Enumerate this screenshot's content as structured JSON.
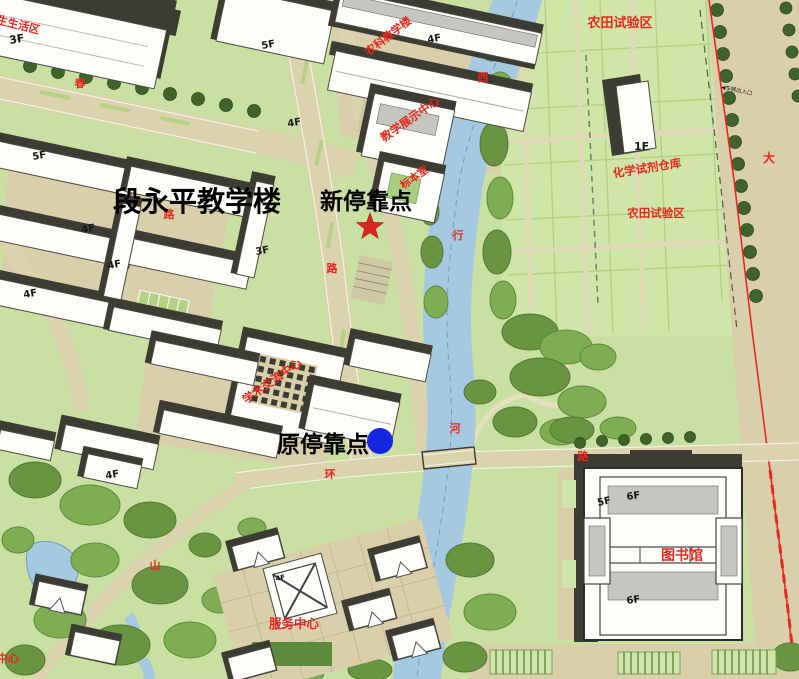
{
  "annotations": {
    "main_building": "段永平教学楼",
    "new_stop": "新停靠点",
    "old_stop": "原停靠点"
  },
  "markers": {
    "new_stop_type": "red-star",
    "old_stop_type": "blue-dot"
  },
  "map_labels": {
    "farmland_north": "农田试验区",
    "farmland_south": "农田试验区",
    "chemical_warehouse": "化学试剂仓库",
    "agri_teaching_building": "农科教学楼",
    "teaching_exhibition_center": "教学展示中心",
    "specimen_room": "标本室",
    "exchange_center": "学术交流中心",
    "library": "图书馆",
    "service_center": "服务中心",
    "student_area_partial": "学生生活区",
    "center_partial": "中心",
    "vehicle_entrance": "◀车辆出入口"
  },
  "floor_labels": [
    "3F",
    "5F",
    "4F",
    "4F",
    "4F",
    "5F",
    "4F",
    "4F",
    "3F",
    "4F",
    "4F",
    "1F",
    "5F",
    "6F",
    "6F"
  ],
  "road_chars": [
    "西",
    "行",
    "河",
    "路",
    "环",
    "路",
    "大",
    "春",
    "路",
    "山"
  ],
  "colors": {
    "annotation_black": "#000000",
    "map_label_red": "#e8281e",
    "marker_red": "#d9261c",
    "marker_blue": "#1526e0",
    "river_blue": "#a6c9e2",
    "road_tan": "#dbd3ad",
    "grass_green": "#c9e0a2",
    "tree_green": "#3f632b",
    "building_shadow": "#3c3c33"
  }
}
